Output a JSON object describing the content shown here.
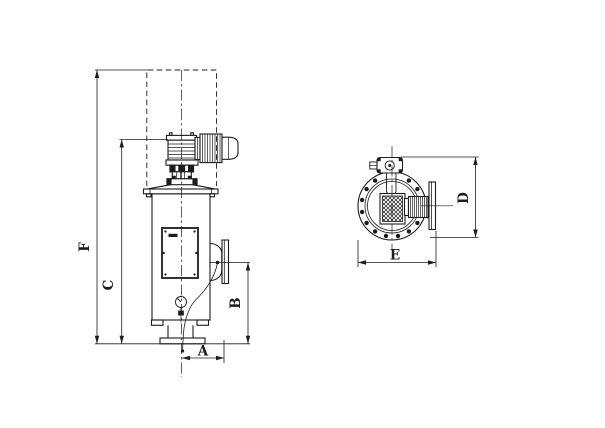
{
  "palette": {
    "ink": "#1c1c1c",
    "paper": "#ffffff"
  },
  "labels": {
    "F": "F",
    "C": "C",
    "B": "B",
    "A": "A",
    "D": "D",
    "E": "E"
  }
}
